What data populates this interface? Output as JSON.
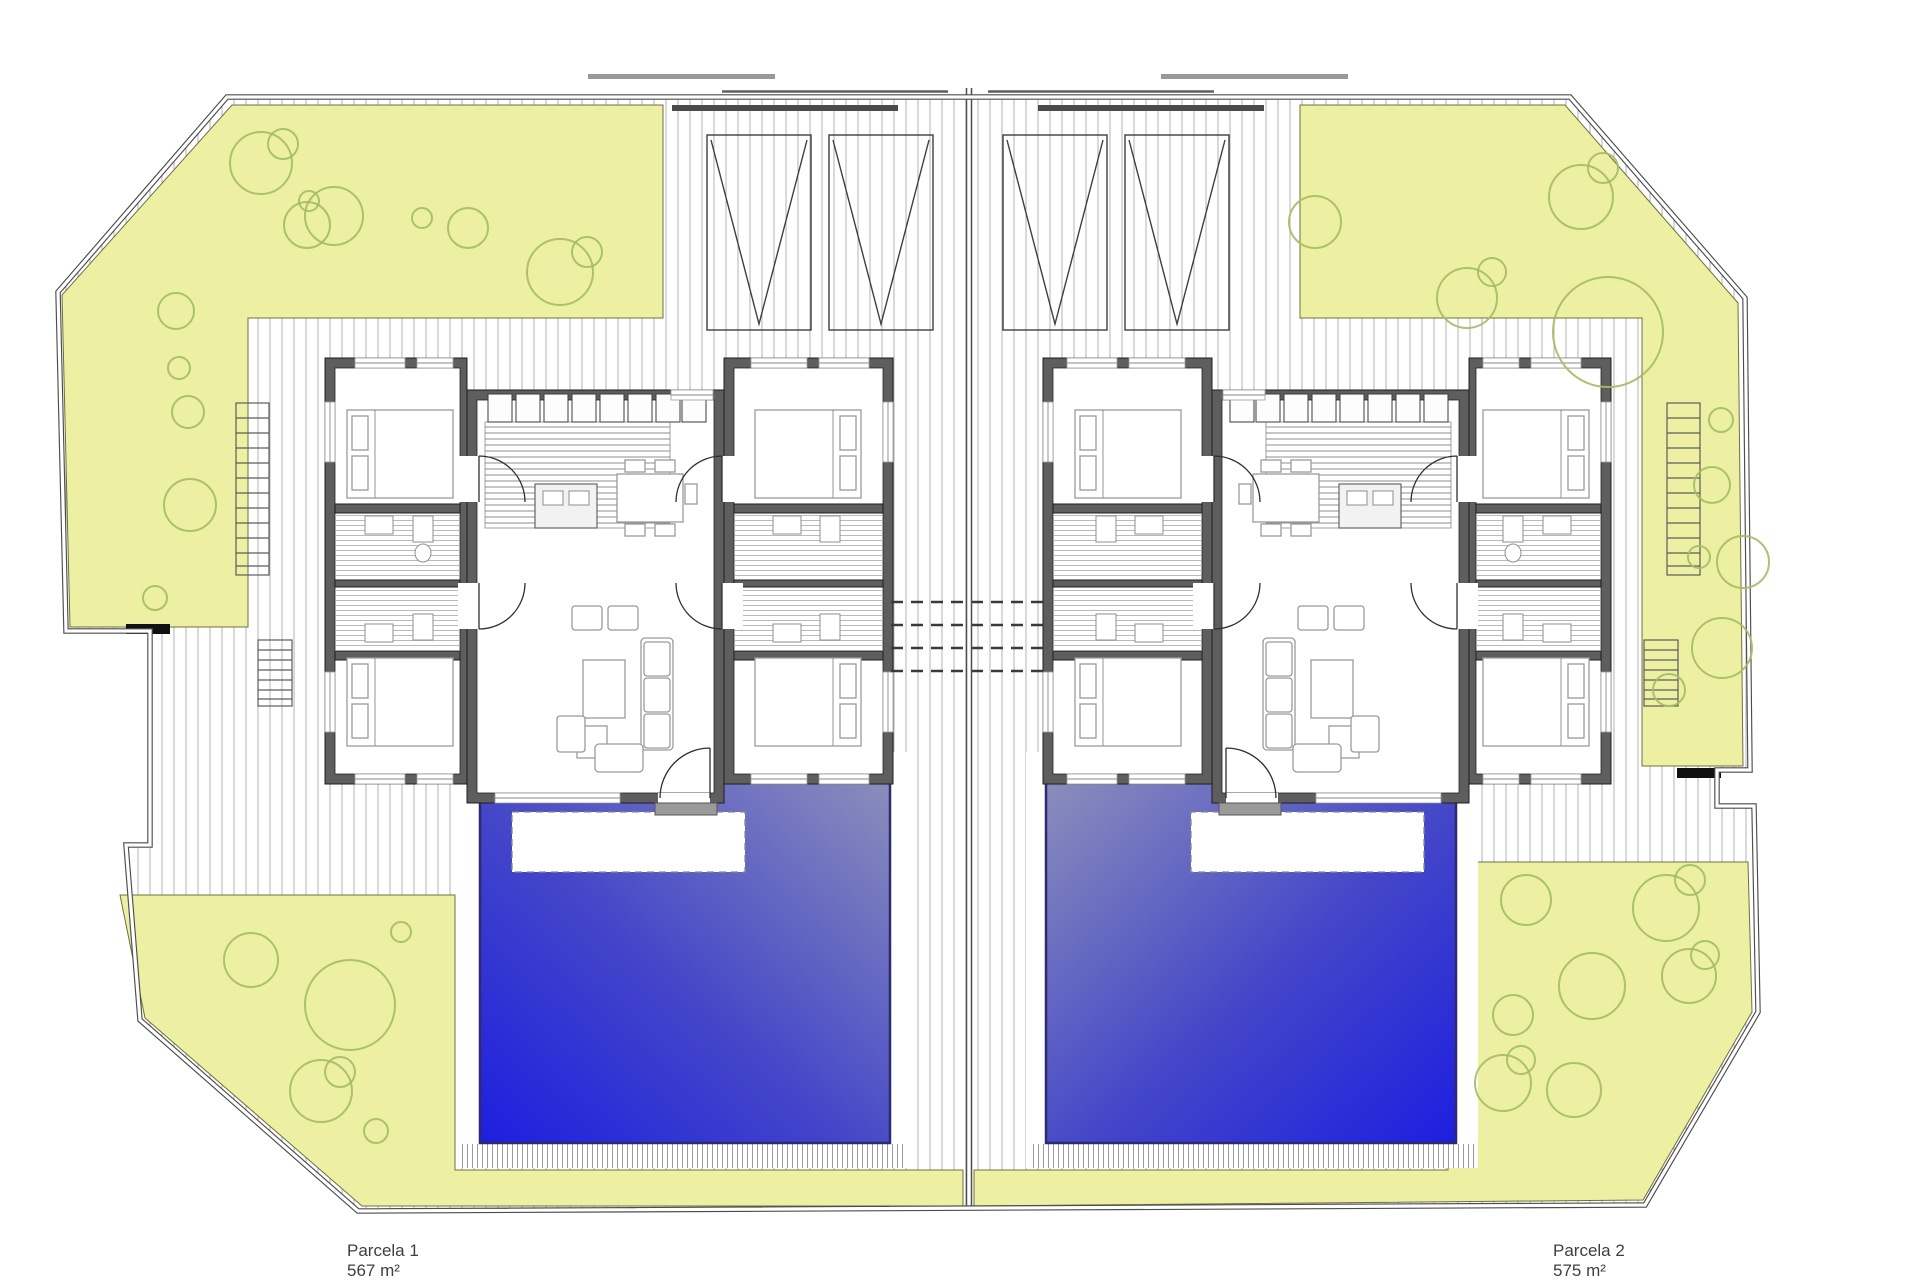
{
  "parcels": [
    {
      "label": "Parcela 1",
      "area": "567 m²"
    },
    {
      "label": "Parcela 2",
      "area": "575 m²"
    }
  ],
  "colors": {
    "garden": "#edf0a3",
    "garden_line": "#6f7042",
    "tree": "#a2bd63",
    "hatch": "#b3b3b3",
    "hatch_dense": "#9a9a9a",
    "wall": "#5e5e5e",
    "wall_edge": "#1d1d1d",
    "boundary": "#4d4d4d",
    "pool_deep": "#1e1ee0",
    "pool_light": "#8d90ba",
    "pool_border": "#2b2b6e",
    "furniture": "#9a9a9a",
    "fixture": "#8f8f8f",
    "gate": "#4a4a4a",
    "label": "#3f3f3f"
  },
  "trees": [
    [
      261,
      163,
      31
    ],
    [
      283,
      144,
      15
    ],
    [
      307,
      225,
      23
    ],
    [
      334,
      216,
      29
    ],
    [
      309,
      201,
      10
    ],
    [
      422,
      218,
      10
    ],
    [
      468,
      228,
      20
    ],
    [
      560,
      272,
      33
    ],
    [
      587,
      252,
      15
    ],
    [
      176,
      311,
      18
    ],
    [
      179,
      368,
      11
    ],
    [
      188,
      412,
      16
    ],
    [
      190,
      505,
      26
    ],
    [
      155,
      598,
      12
    ],
    [
      1315,
      222,
      26
    ],
    [
      1467,
      298,
      30
    ],
    [
      1492,
      272,
      14
    ],
    [
      1581,
      197,
      32
    ],
    [
      1603,
      168,
      15
    ],
    [
      1608,
      332,
      55
    ],
    [
      1721,
      420,
      12
    ],
    [
      1712,
      485,
      18
    ],
    [
      1699,
      557,
      11
    ],
    [
      1743,
      562,
      26
    ],
    [
      1722,
      648,
      30
    ],
    [
      1669,
      690,
      16
    ],
    [
      251,
      960,
      27
    ],
    [
      350,
      1005,
      45
    ],
    [
      321,
      1091,
      31
    ],
    [
      340,
      1072,
      15
    ],
    [
      376,
      1131,
      12
    ],
    [
      401,
      932,
      10
    ],
    [
      1526,
      900,
      25
    ],
    [
      1666,
      908,
      33
    ],
    [
      1690,
      880,
      15
    ],
    [
      1592,
      986,
      33
    ],
    [
      1513,
      1015,
      20
    ],
    [
      1689,
      976,
      27
    ],
    [
      1705,
      955,
      14
    ],
    [
      1503,
      1083,
      28
    ],
    [
      1521,
      1060,
      14
    ],
    [
      1574,
      1090,
      27
    ]
  ]
}
